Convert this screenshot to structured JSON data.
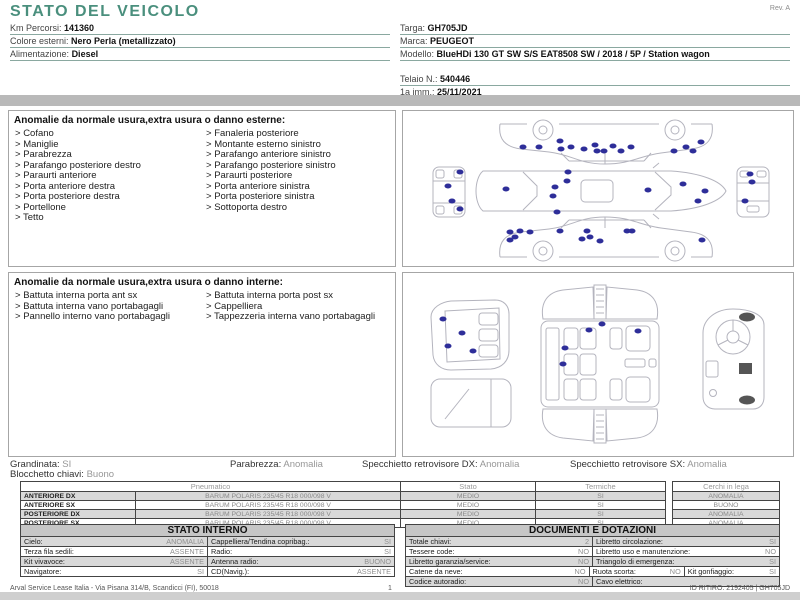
{
  "colors": {
    "accent_teal": "#4a8f7d",
    "divider_gray": "#b9b9b9",
    "damage_dot": "#2e2e99"
  },
  "page": {
    "rev": "Rev. A",
    "footer_left": "Arval Service Lease Italia - Via Pisana 314/B, Scandicci (FI), 50018",
    "page_number": "1",
    "footer_right": "ID RITIRO: 2192405 | GH705JD"
  },
  "header": {
    "title": "STATO DEL VEICOLO",
    "left_fields": [
      {
        "label": "Km Percorsi:",
        "value": "141360"
      },
      {
        "label": "Colore esterni:",
        "value": "Nero Perla (metallizzato)"
      },
      {
        "label": "Alimentazione:",
        "value": "Diesel"
      }
    ],
    "right_fields": [
      {
        "label": "Targa:",
        "value": "GH705JD"
      },
      {
        "label": "Marca:",
        "value": "PEUGEOT"
      },
      {
        "label": "Modello:",
        "value": "BlueHDi 130 GT SW S/S EAT8508 SW / 2018 / 5P / Station wagon"
      },
      {
        "label": "Telaio N.:",
        "value": "540446"
      },
      {
        "label": "1a imm.:",
        "value": "25/11/2021"
      }
    ]
  },
  "exterior": {
    "title": "Anomalie da normale usura,extra usura o danno esterne:",
    "col1": [
      "Cofano",
      "Maniglie",
      "Parabrezza",
      "Parafango posteriore destro",
      "Paraurti anteriore",
      "Porta anteriore destra",
      "Porta posteriore destra",
      "Portellone",
      "Tetto"
    ],
    "col2": [
      "Fanaleria posteriore",
      "Montante esterno sinistro",
      "Parafango anteriore sinistro",
      "Parafango posteriore sinistro",
      "Paraurti posteriore",
      "Porta anteriore sinistra",
      "Porta posteriore sinistra",
      "Sottoporta destro"
    ],
    "dots": [
      [
        120,
        36
      ],
      [
        136,
        36
      ],
      [
        157,
        30
      ],
      [
        158,
        38
      ],
      [
        168,
        36
      ],
      [
        181,
        38
      ],
      [
        192,
        34
      ],
      [
        194,
        40
      ],
      [
        201,
        40
      ],
      [
        210,
        35
      ],
      [
        218,
        40
      ],
      [
        228,
        36
      ],
      [
        271,
        40
      ],
      [
        283,
        36
      ],
      [
        290,
        40
      ],
      [
        298,
        31
      ],
      [
        103,
        78
      ],
      [
        152,
        76
      ],
      [
        150,
        85
      ],
      [
        164,
        70
      ],
      [
        165,
        61
      ],
      [
        245,
        79
      ],
      [
        280,
        73
      ],
      [
        302,
        80
      ],
      [
        295,
        90
      ],
      [
        154,
        101
      ],
      [
        107,
        121
      ],
      [
        112,
        126
      ],
      [
        117,
        120
      ],
      [
        127,
        121
      ],
      [
        107,
        129
      ],
      [
        157,
        120
      ],
      [
        179,
        128
      ],
      [
        184,
        120
      ],
      [
        187,
        126
      ],
      [
        197,
        130
      ],
      [
        224,
        120
      ],
      [
        229,
        120
      ],
      [
        299,
        129
      ],
      [
        45,
        75
      ],
      [
        49,
        90
      ],
      [
        57,
        61
      ],
      [
        57,
        98
      ],
      [
        347,
        63
      ],
      [
        349,
        71
      ],
      [
        342,
        90
      ]
    ]
  },
  "interior": {
    "title": "Anomalie da normale usura,extra usura o danno interne:",
    "col1": [
      "Battuta interna porta ant sx",
      "Battuta interna vano portabagagli",
      "Pannello interno vano portabagagli"
    ],
    "col2": [
      "Battuta interna porta post sx",
      "Cappelliera",
      "Tappezzeria interna vano portabagagli"
    ],
    "dots": [
      [
        40,
        46
      ],
      [
        59,
        60
      ],
      [
        45,
        73
      ],
      [
        70,
        78
      ],
      [
        199,
        51
      ],
      [
        186,
        57
      ],
      [
        235,
        58
      ],
      [
        162,
        75
      ],
      [
        160,
        91
      ]
    ]
  },
  "summary": {
    "grandinata_label": "Grandinata:",
    "grandinata": "SI",
    "blocchetto_label": "Blocchetto chiavi:",
    "blocchetto": "Buono",
    "parabrezza_label": "Parabrezza:",
    "parabrezza": "Anomalia",
    "specchietto_dx_label": "Specchietto retrovisore DX:",
    "specchietto_dx": "Anomalia",
    "specchietto_sx_label": "Specchietto retrovisore SX:",
    "specchietto_sx": "Anomalia"
  },
  "tires": {
    "headers": [
      "Pneumatico",
      "Stato",
      "Termiche",
      "Cerchi in lega"
    ],
    "rows": [
      {
        "pos": "ANTERIORE DX",
        "tire": "BARUM POLARIS 235/45 R18 000/098 V",
        "stato": "MEDIO",
        "termiche": "SI"
      },
      {
        "pos": "ANTERIORE SX",
        "tire": "BARUM POLARIS 235/45 R18 000/098 V",
        "stato": "MEDIO",
        "termiche": "SI"
      },
      {
        "pos": "POSTERIORE DX",
        "tire": "BARUM POLARIS 235/45 R18 000/098 V",
        "stato": "MEDIO",
        "termiche": "SI"
      },
      {
        "pos": "POSTERIORE SX",
        "tire": "BARUM POLARIS 235/45 R18 000/098 V",
        "stato": "MEDIO",
        "termiche": "SI"
      }
    ],
    "cerchi": [
      "ANOMALIA",
      "BUONO",
      "ANOMALIA",
      "ANOMALIA"
    ]
  },
  "stato_interno": {
    "title": "STATO INTERNO",
    "pairs": [
      {
        "label": "Cielo:",
        "value": "ANOMALIA"
      },
      {
        "label": "Cappelliera/Tendina copribag.:",
        "value": "SI"
      },
      {
        "label": "Terza fila sedili:",
        "value": "ASSENTE"
      },
      {
        "label": "Radio:",
        "value": "SI"
      },
      {
        "label": "Kit vivavoce:",
        "value": "ASSENTE"
      },
      {
        "label": "Antenna radio:",
        "value": "BUONO"
      },
      {
        "label": "Navigatore:",
        "value": "SI"
      },
      {
        "label": "CD(Navig.):",
        "value": "ASSENTE"
      }
    ]
  },
  "documenti": {
    "title": "DOCUMENTI E DOTAZIONI",
    "pairs": [
      {
        "label": "Totale chiavi:",
        "value": "2"
      },
      {
        "label": "Libretto circolazione:",
        "value": "SI"
      },
      {
        "label": "Tessere code:",
        "value": "NO"
      },
      {
        "label": "Libretto uso e manutenzione:",
        "value": "NO"
      },
      {
        "label": "Libretto garanzia/service:",
        "value": "NO"
      },
      {
        "label": "Triangolo di emergenza:",
        "value": "SI"
      },
      {
        "label": "Catene da neve:",
        "value": "NO"
      },
      {
        "label": "Ruota scorta:",
        "value": "NO"
      },
      {
        "label": "Kit gonfiaggio:",
        "value": "SI"
      },
      {
        "label": "Codice autoradio:",
        "value": "NO"
      },
      {
        "label": "Cavo elettrico:",
        "value": ""
      }
    ]
  }
}
